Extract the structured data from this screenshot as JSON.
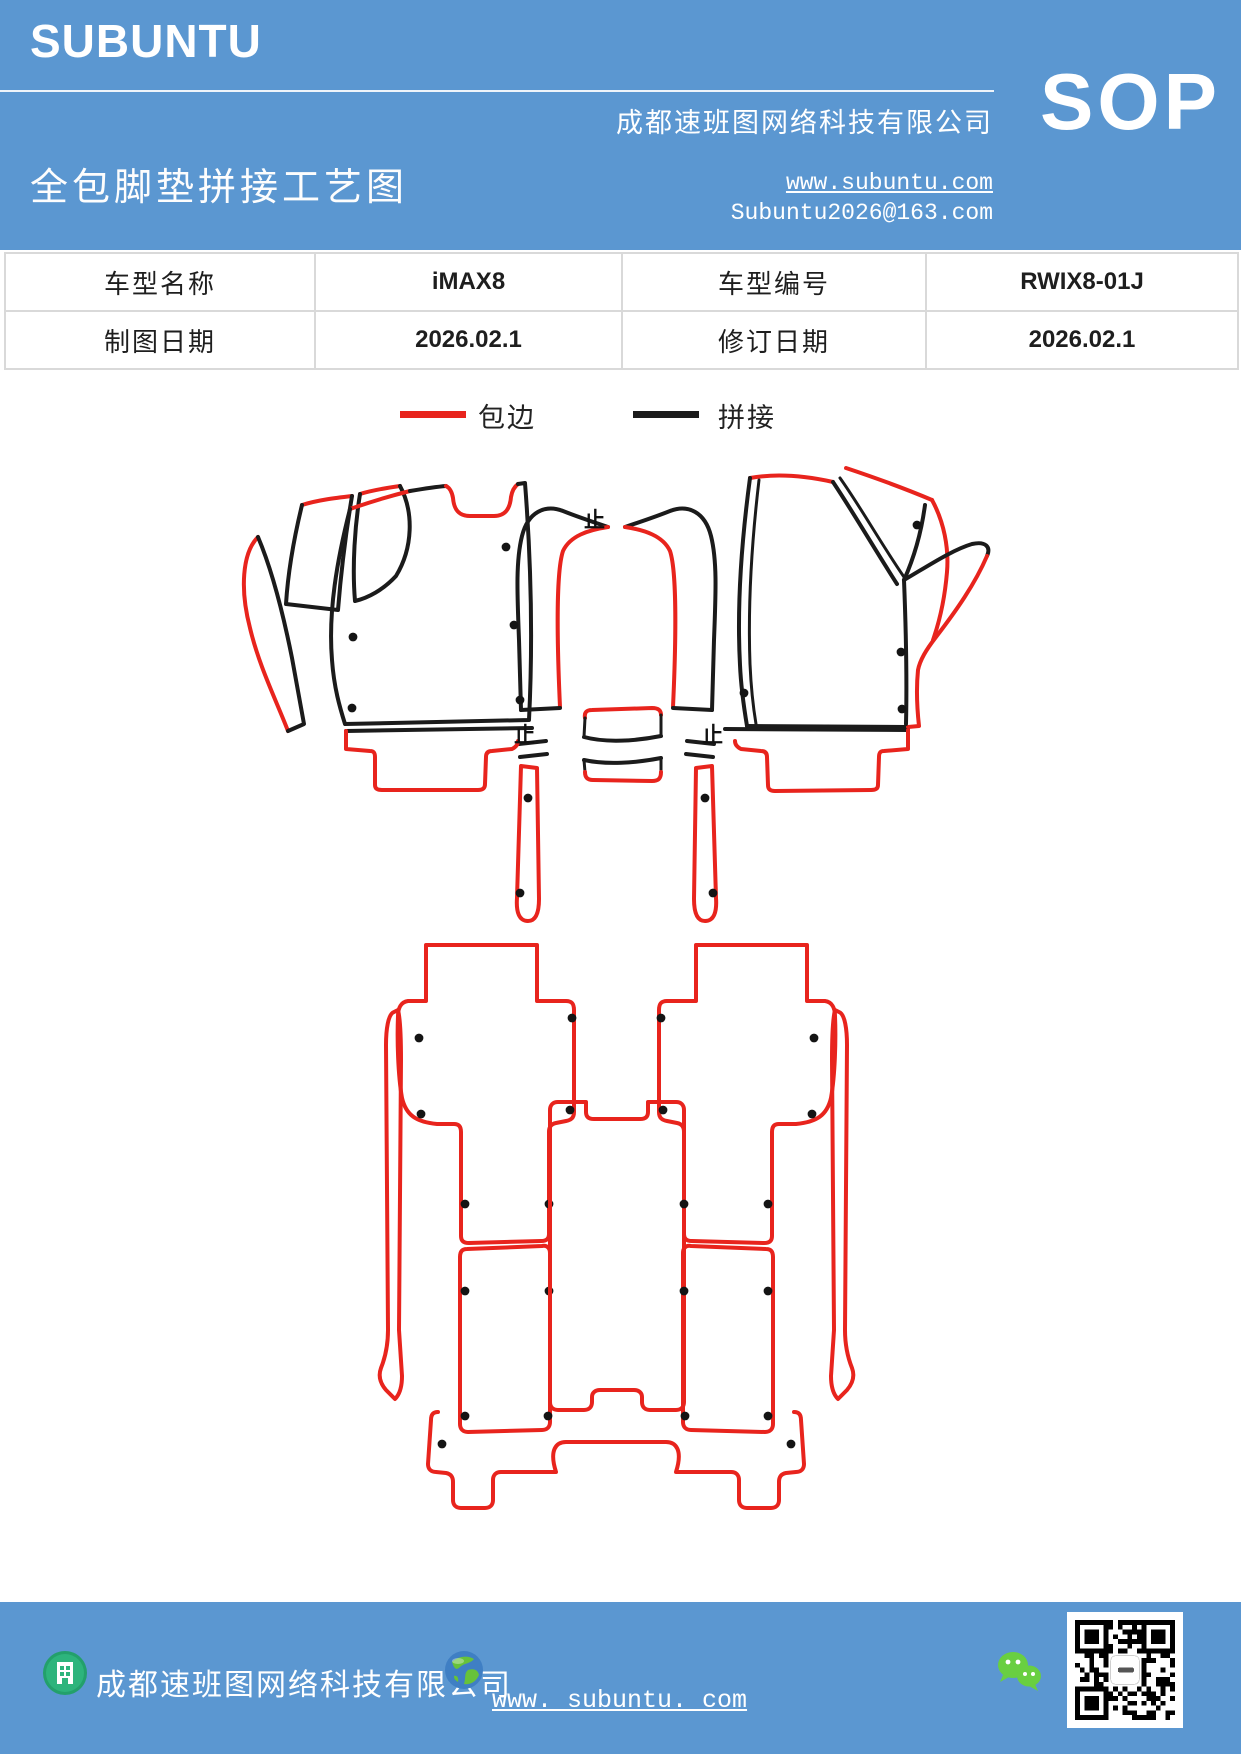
{
  "header": {
    "logo": "SUBUNTU",
    "company": "成都速班图网络科技有限公司",
    "sop": "SOP",
    "title": "全包脚垫拼接工艺图",
    "website": "www.subuntu.com",
    "email": "Subuntu2026@163.com"
  },
  "table": {
    "rows": [
      {
        "cells": [
          "车型名称",
          "iMAX8",
          "车型编号",
          "RWIX8-01J"
        ]
      },
      {
        "cells": [
          "制图日期",
          "2026.02.1",
          "修订日期",
          "2026.02.1"
        ]
      }
    ]
  },
  "legend": {
    "items": [
      {
        "label": "包边",
        "color": "#e8241d"
      },
      {
        "label": "拼接",
        "color": "#1b1b1b"
      }
    ]
  },
  "footer": {
    "company": "成都速班图网络科技有限公司",
    "website": "www. subuntu. com"
  },
  "qr": {
    "modules": 21,
    "seed": 7
  },
  "diagram": {
    "colors": {
      "edge": "#e8241d",
      "splice": "#1b1b1b"
    },
    "mirror_axis": 1233,
    "mark_glyph": "止",
    "marks": [
      {
        "x": 584,
        "y": 527
      },
      {
        "x": 514,
        "y": 742
      },
      {
        "x": 702,
        "y": 742
      }
    ],
    "dots_main": [
      [
        506,
        547
      ],
      [
        353,
        637
      ],
      [
        352,
        708
      ],
      [
        514,
        625
      ],
      [
        520,
        700
      ],
      [
        917,
        525
      ],
      [
        744,
        693
      ],
      [
        901,
        652
      ],
      [
        902,
        709
      ]
    ],
    "dots_half": [
      [
        419,
        1038
      ],
      [
        572,
        1018
      ],
      [
        421,
        1114
      ],
      [
        570,
        1110
      ],
      [
        465,
        1204
      ],
      [
        549,
        1204
      ],
      [
        465,
        1291
      ],
      [
        549,
        1291
      ],
      [
        465,
        1416
      ],
      [
        548,
        1416
      ],
      [
        442,
        1444
      ],
      [
        528,
        798
      ],
      [
        520,
        893
      ]
    ],
    "paths": [
      {
        "g": "main",
        "k": "edge",
        "w": 4,
        "d": "M258,537 C242,553 240,590 250,628 C259,666 276,700 288,731"
      },
      {
        "g": "main",
        "k": "splice",
        "w": 4,
        "d": "M258,537 C272,570 284,618 292,658 C298,690 302,712 304,724 L288,731"
      },
      {
        "g": "main",
        "k": "edge",
        "w": 4,
        "d": "M302,505 C318,500 335,498 352,496"
      },
      {
        "g": "main",
        "k": "splice",
        "w": 4,
        "d": "M302,505 C294,538 288,572 286,604 L338,610 C341,572 346,532 352,496"
      },
      {
        "g": "main",
        "k": "edge",
        "w": 4,
        "d": "M360,494 C373,490 386,488 400,486"
      },
      {
        "g": "main",
        "k": "splice",
        "w": 4,
        "d": "M400,486 C414,512 413,548 396,576 C383,590 368,598 355,601 C352,566 355,525 360,494"
      },
      {
        "g": "main",
        "k": "edge",
        "w": 4,
        "d": "M350,509 C370,502 390,496 410,491"
      },
      {
        "g": "main",
        "k": "splice",
        "w": 4,
        "d": "M410,491 C422,489 434,487 446,486"
      },
      {
        "g": "main",
        "k": "edge",
        "w": 4,
        "d": "M446,486 C450,488 452,492 453,498 C454,510 459,516 470,516 L494,516 C505,516 510,509 511,497 C512,491 514,487 518,484"
      },
      {
        "g": "main",
        "k": "splice",
        "w": 4,
        "d": "M350,509 C337,560 328,612 332,660 C334,688 340,708 345,724 L529,720 C533,640 531,560 525,483 L518,484"
      },
      {
        "g": "main",
        "k": "splice",
        "w": 4,
        "d": "M346,731 L532,728"
      },
      {
        "g": "main",
        "k": "edge",
        "w": 4,
        "d": "M346,731 L346,749 L370,751 C374,751 375,753 375,757 L375,785 C375,789 378,790 382,790 L478,790 C483,790 485,788 485,784 L486,757 C486,753 488,751 492,751 L512,749 C516,747 518,744 518,741"
      },
      {
        "g": "main",
        "k": "edge",
        "w": 4,
        "d": "M750,478 C778,473 806,476 833,482"
      },
      {
        "g": "main",
        "k": "splice",
        "w": 4,
        "d": "M750,478 C741,545 737,610 740,665 C741,688 744,708 747,726"
      },
      {
        "g": "main",
        "k": "splice",
        "w": 3,
        "d": "M759,480 C751,548 748,610 750,664 C751,687 753,706 756,724"
      },
      {
        "g": "main",
        "k": "splice",
        "w": 4,
        "d": "M747,726 L908,727"
      },
      {
        "g": "main",
        "k": "splice",
        "w": 4,
        "d": "M833,482 C853,512 874,548 897,584"
      },
      {
        "g": "main",
        "k": "splice",
        "w": 3,
        "d": "M840,478 C860,506 880,542 904,577"
      },
      {
        "g": "main",
        "k": "edge",
        "w": 4,
        "d": "M846,468 C876,478 906,489 932,500"
      },
      {
        "g": "main",
        "k": "edge",
        "w": 4,
        "d": "M932,500 C944,522 949,548 947,572 C945,596 940,620 933,640"
      },
      {
        "g": "main",
        "k": "splice",
        "w": 4,
        "d": "M925,505 C921,535 913,560 904,580"
      },
      {
        "g": "main",
        "k": "splice",
        "w": 4,
        "d": "M904,580 C928,566 952,550 972,544 C986,541 991,547 987,556"
      },
      {
        "g": "main",
        "k": "edge",
        "w": 4,
        "d": "M987,556 C975,584 956,611 936,637 C926,650 920,660 918,670 C916,690 917,708 919,726 L908,727"
      },
      {
        "g": "main",
        "k": "splice",
        "w": 4,
        "d": "M904,580 C906,630 907,680 906,724"
      },
      {
        "g": "main",
        "k": "splice",
        "w": 4,
        "d": "M725,729 L908,730"
      },
      {
        "g": "main",
        "k": "edge",
        "w": 4,
        "d": "M908,730 L908,749 L884,751 C880,751 879,753 879,757 L878,785 C878,789 875,790 871,790 L775,791 C770,791 768,789 768,785 L767,757 C767,753 765,751 761,751 L741,749 C737,747 735,744 735,741"
      },
      {
        "g": "main",
        "k": "edge",
        "w": 4,
        "d": "M585,718 C584,712 587,710 592,710 L652,708 C658,708 661,710 661,715"
      },
      {
        "g": "main",
        "k": "splice",
        "w": 4,
        "d": "M584,737 C606,743 636,741 661,736"
      },
      {
        "g": "main",
        "k": "splice",
        "w": 4,
        "d": "M584,760 C606,765 636,763 661,758"
      },
      {
        "g": "main",
        "k": "splice",
        "w": 3,
        "d": "M585,718 L584,737 M584,760 L585,772 M661,715 L661,736 M661,758 L661,771"
      },
      {
        "g": "main",
        "k": "edge",
        "w": 4,
        "d": "M585,772 C585,778 588,780 593,780 L652,781 C658,781 661,779 661,772"
      },
      {
        "g": "main",
        "k": "edge",
        "w": 4,
        "d": "M550,1110 C550,1105 553,1102 558,1102 L586,1102 L586,1112 C586,1117 589,1119 594,1119 L640,1119 C645,1119 648,1117 648,1112 L648,1102 L676,1102 C681,1102 684,1105 684,1110 L684,1402 C684,1407 681,1410 676,1410 L650,1410 C645,1410 642,1407 642,1402 L642,1397 C642,1393 639,1390 634,1390 L600,1390 C595,1390 592,1393 592,1397 L592,1402 C592,1407 589,1410 584,1410 L558,1410 C553,1410 550,1407 550,1402 Z"
      },
      {
        "g": "main",
        "k": "edge",
        "w": 4,
        "d": "M438,1412 C433,1412 431,1415 431,1420 L428,1464 C428,1469 431,1472 436,1472 L446,1473 C451,1474 453,1477 453,1482 L453,1500 C453,1505 456,1508 461,1508 L485,1508 C490,1508 493,1505 493,1500 L493,1480 C493,1475 496,1472 501,1472 L556,1472 C549,1450 556,1442 566,1442 L666,1442 C676,1442 683,1450 676,1472 L731,1472 C736,1472 739,1475 739,1480 L739,1500 C739,1505 742,1508 747,1508 L771,1508 C776,1508 779,1505 779,1500 L779,1482 C779,1477 781,1474 786,1473 L796,1472 C801,1472 804,1469 804,1464 L801,1420 C801,1415 799,1412 794,1412"
      },
      {
        "g": "half",
        "k": "splice",
        "w": 4,
        "d": "M521,710 L519,640 C517,590 516,560 522,536 C528,512 545,504 563,511 C578,517 593,522 608,527"
      },
      {
        "g": "half",
        "k": "edge",
        "w": 4,
        "d": "M608,527 C588,530 570,536 563,551 C556,572 557,642 560,707"
      },
      {
        "g": "half",
        "k": "splice",
        "w": 4,
        "d": "M521,710 L560,708"
      },
      {
        "g": "half",
        "k": "splice",
        "w": 4,
        "d": "M519,744 L546,741 M520,757 L547,754"
      },
      {
        "g": "half",
        "k": "edge",
        "w": 4,
        "d": "M521,766 L517,898 C516,912 519,921 528,921 C536,921 539,913 539,899 L537,768 Z"
      },
      {
        "g": "half",
        "k": "edge",
        "w": 4,
        "d": "M426,945 L537,945 L537,1001 L566,1001 C572,1001 574,1004 574,1010 L574,1112 C574,1118 571,1120 566,1121 L556,1123 C551,1124 549,1127 549,1132 L549,1234 C549,1239 546,1241 541,1241 L469,1243 C464,1243 461,1241 461,1236 L461,1132 C461,1127 459,1124 454,1124 L437,1124 C416,1122 406,1115 402,1098 C398,1075 397,1040 398,1016 C398,1008 401,1002 408,1001 L426,1001 Z"
      },
      {
        "g": "half",
        "k": "edge",
        "w": 4,
        "d": "M394,1012 C388,1014 386,1030 386,1045 L388,1330 C388,1346 385,1358 381,1368 C378,1376 380,1383 386,1390 L395,1399 C400,1394 402,1386 402,1376 L399,1330 L401,1060 C401,1035 400,1018 398,1010 Z"
      },
      {
        "g": "half",
        "k": "edge",
        "w": 4,
        "d": "M467,1249 C462,1249 460,1252 460,1257 L460,1424 C460,1429 463,1432 468,1432 L542,1430 C547,1430 550,1427 550,1422 L550,1253 C550,1248 547,1245 542,1246 Z"
      }
    ]
  }
}
